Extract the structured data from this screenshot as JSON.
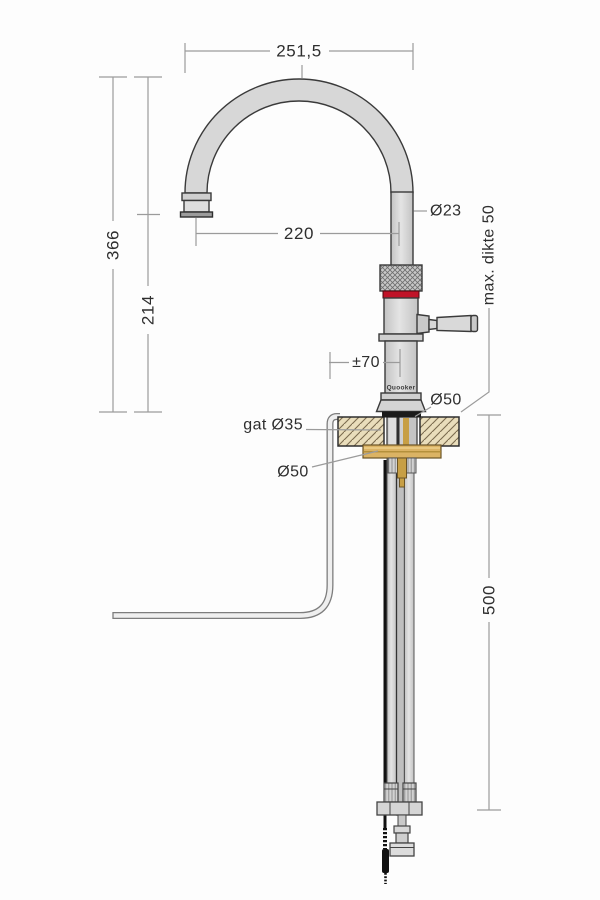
{
  "drawing": {
    "brand": "Quooker",
    "labels": {
      "arc_width": "251,5",
      "total_height": "366",
      "outlet_height": "214",
      "spout_reach": "220",
      "tube_diameter": "Ø23",
      "max_counter_thickness": "max. dikte 50",
      "swivel_range": "±70",
      "base_diameter": "Ø50",
      "hole_diameter": "gat Ø35",
      "flange_diameter": "Ø50",
      "below_counter_length": "500"
    },
    "colors": {
      "accent_red": "#c01328",
      "brass": "#dbb364",
      "countertop_fill": "#e9ddbb",
      "metal_fill": "#d7d7d7",
      "dimension_line": "#9b9b9b",
      "outline": "#3a3a3a"
    }
  }
}
